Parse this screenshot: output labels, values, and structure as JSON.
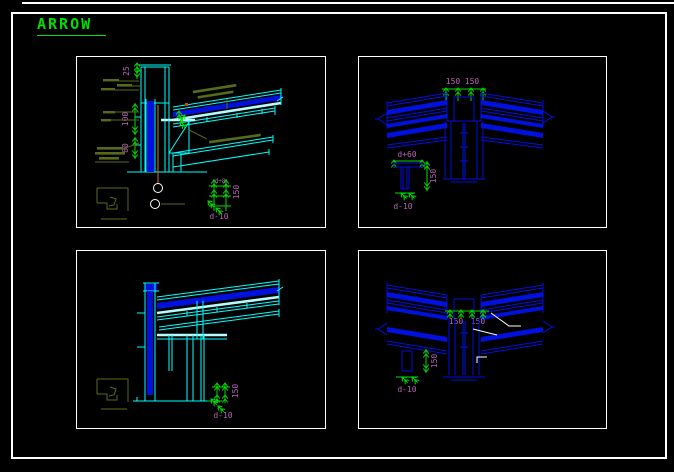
{
  "title": {
    "text": "ARROW"
  },
  "colors": {
    "bg": "#000000",
    "frame": "#ffffff",
    "blue": "#0010dd",
    "cyan": "#00ffff",
    "pale": "#b8fbff",
    "green": "#00dd00",
    "olive": "#566b1a",
    "magenta": "#b565b5",
    "orange": "#c97b3a",
    "reddot": "#cc4a00",
    "white": "#ffffff"
  },
  "panels": {
    "top_left": {
      "name": "eave corner detail",
      "labels": {
        "dim_25": "25",
        "dim_100": "100",
        "dim_80": "80",
        "detail_gauge": "d+8",
        "detail_spacing": "150",
        "detail_note": "d-10"
      }
    },
    "top_right": {
      "name": "ridge detail",
      "labels": {
        "dim_left": "150",
        "dim_right": "150",
        "bolt_width": "d+60",
        "bolt_length": "150",
        "detail_note": "d-10"
      }
    },
    "bottom_left": {
      "name": "eave detail",
      "labels": {
        "detail_spacing": "150",
        "detail_note": "d-10"
      }
    },
    "bottom_right": {
      "name": "valley ridge detail",
      "labels": {
        "dim_left": "150",
        "dim_right": "150",
        "detail_spacing": "150",
        "detail_note": "d-10"
      }
    }
  }
}
